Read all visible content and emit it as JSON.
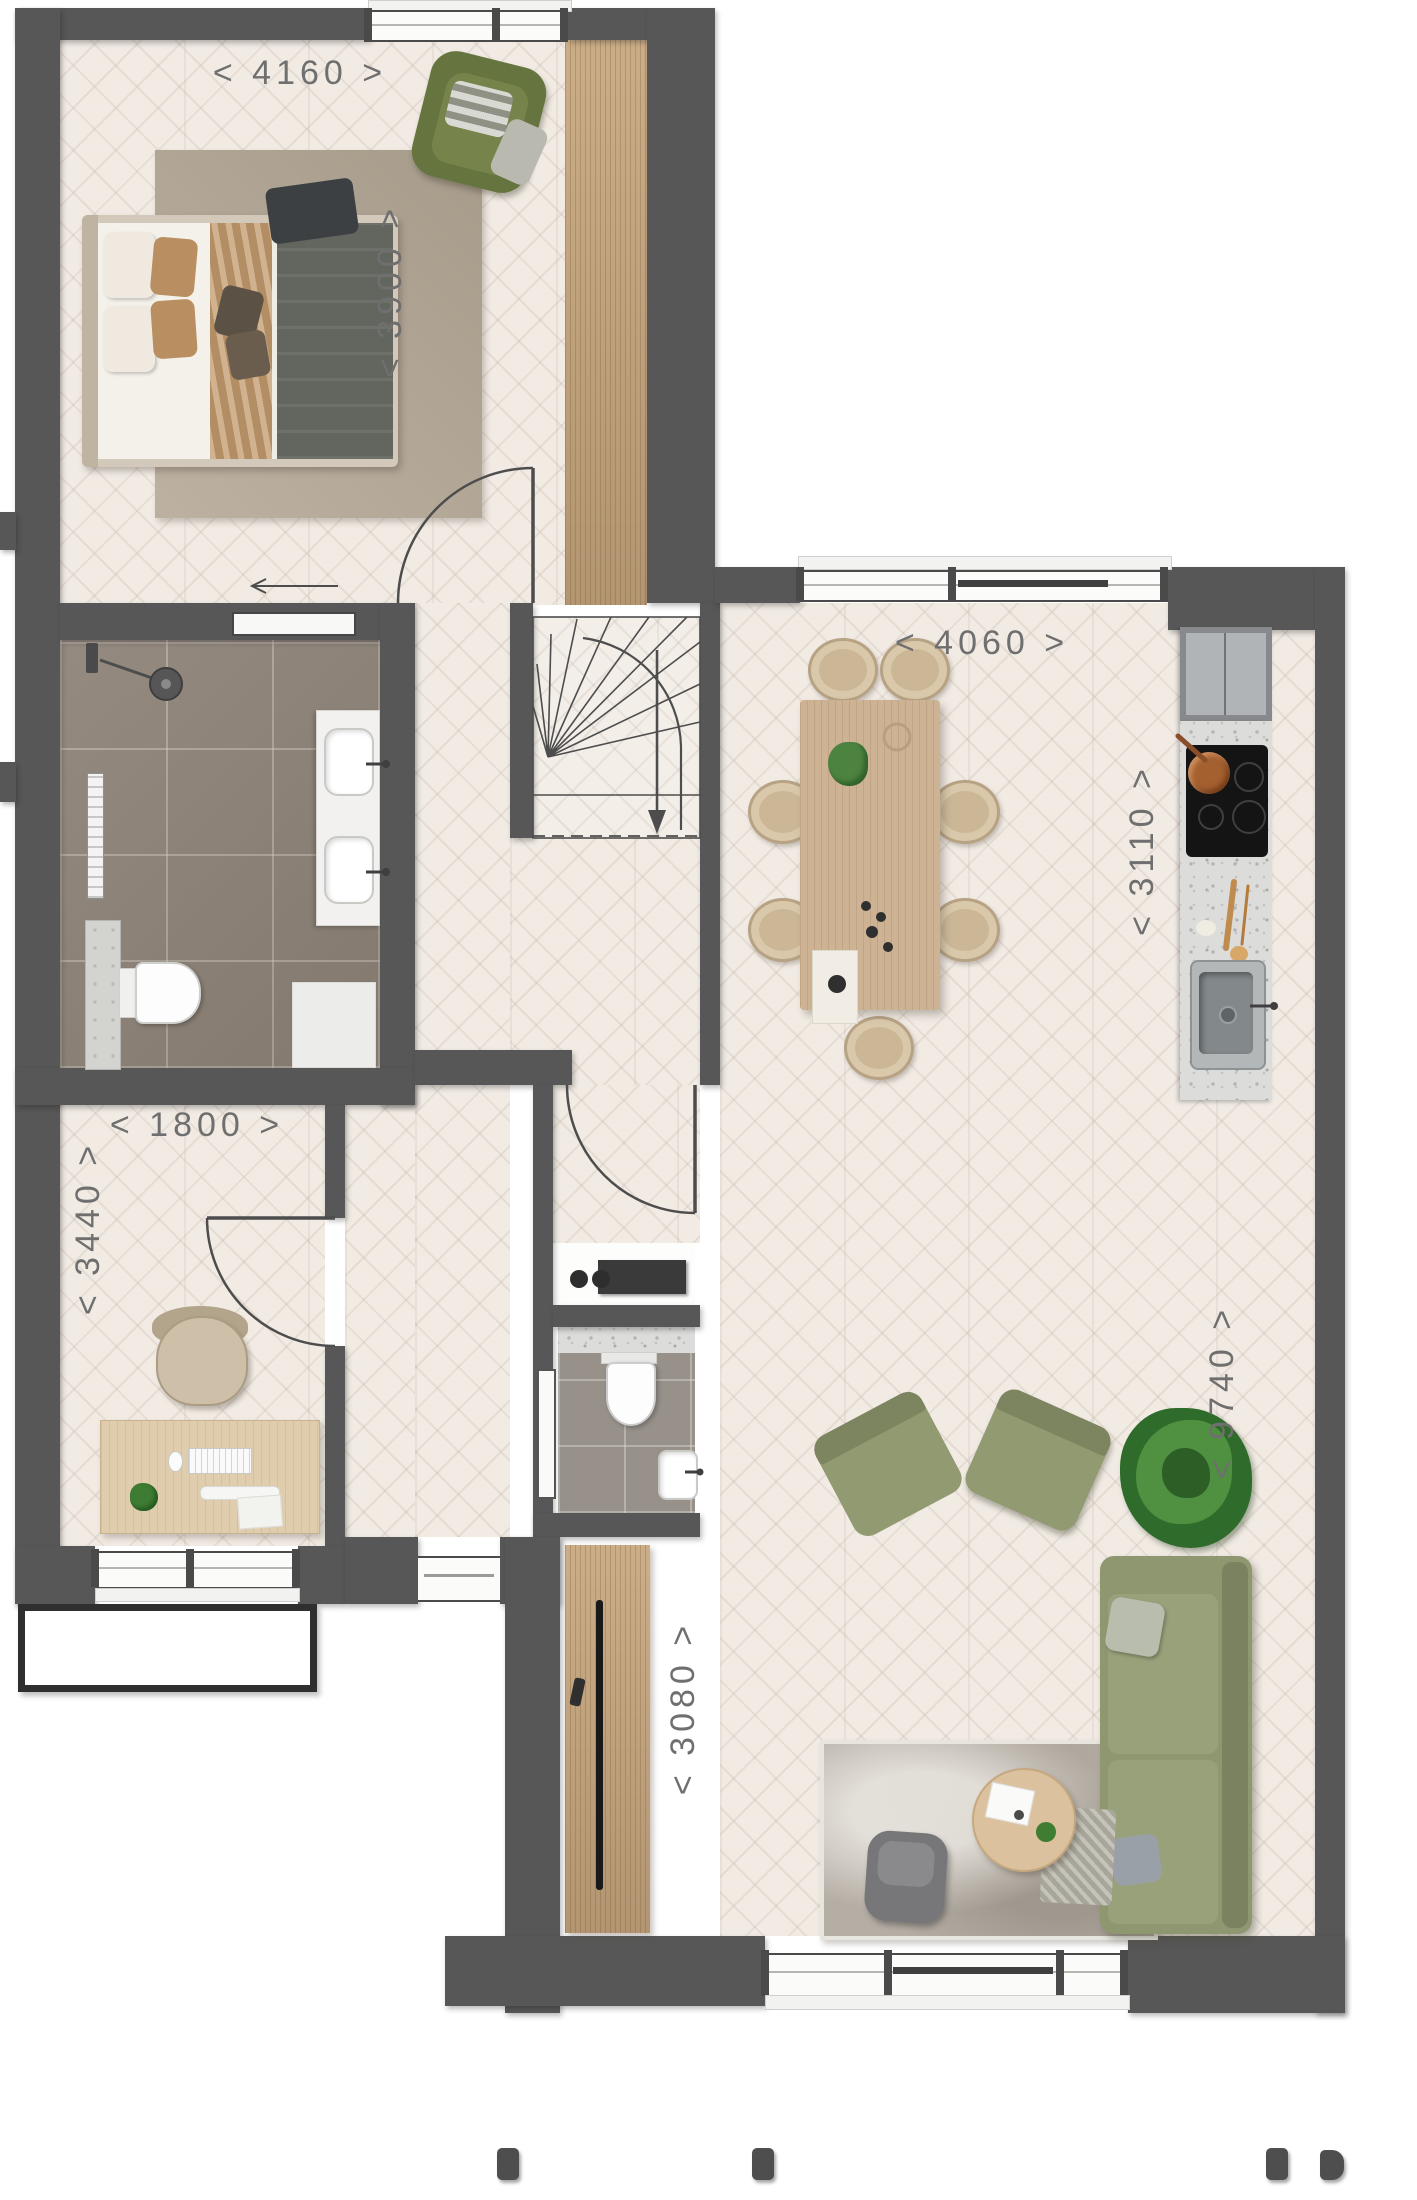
{
  "canvas": {
    "width": 1417,
    "height": 2200
  },
  "colors": {
    "wall": "#575757",
    "floor_wood": "#f1ebe4",
    "bathroom_tile": "#8e8378",
    "wood_accent": "#c7a77e",
    "counter_terrazzo": "#dcdcda",
    "sofa_green": "#8f9770",
    "plant_green": "#3f7d33",
    "rug_gray": "#b7b2aa",
    "dimension_text": "#6f6f6f"
  },
  "dimensions": [
    {
      "id": "bedroom-width",
      "text": "< 4160 >",
      "orientation": "horizontal"
    },
    {
      "id": "bedroom-depth",
      "text": "< 3900 >",
      "orientation": "vertical"
    },
    {
      "id": "living-width",
      "text": "< 4060 >",
      "orientation": "horizontal"
    },
    {
      "id": "kitchen-depth",
      "text": "< 3110 >",
      "orientation": "vertical"
    },
    {
      "id": "study-width",
      "text": "< 1800 >",
      "orientation": "horizontal"
    },
    {
      "id": "study-depth",
      "text": "< 3440 >",
      "orientation": "vertical"
    },
    {
      "id": "living-depth",
      "text": "< 9740 >",
      "orientation": "vertical"
    },
    {
      "id": "tv-wall-width",
      "text": "< 3080 >",
      "orientation": "vertical"
    }
  ]
}
